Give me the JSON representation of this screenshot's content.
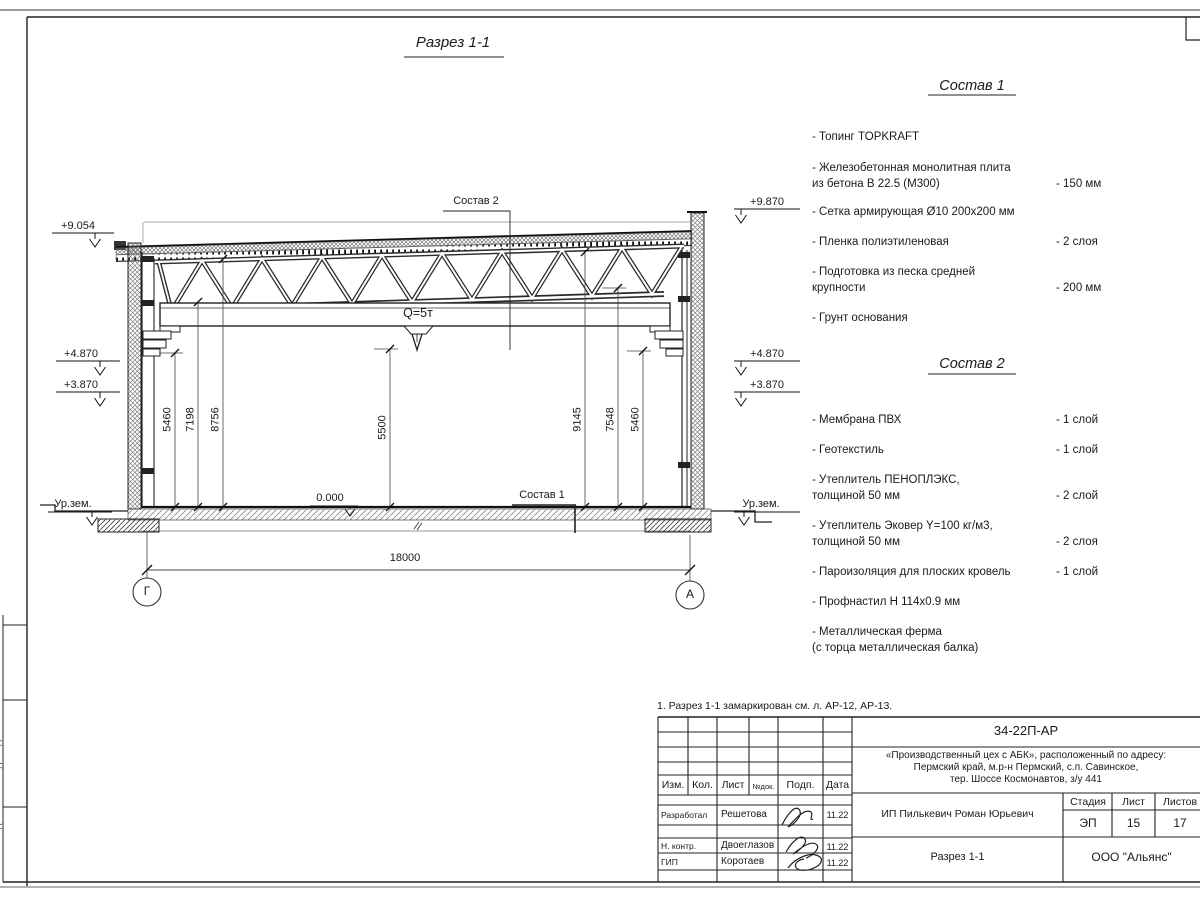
{
  "sheet": {
    "note": "1. Разрез 1-1 замаркирован см. л. АР-12, АР-13.",
    "side_strip": [
      "Взам. инв. №",
      "Подп. и дата",
      "Инв. № подл."
    ]
  },
  "section": {
    "title": "Разрез 1-1",
    "callout_sostav2": "Состав 2",
    "callout_sostav1": "Состав 1",
    "crane_capacity": "Q=5т",
    "zero_level": "0.000",
    "elev_left": {
      "roof": "+9.054",
      "crane": "+4.870",
      "low": "+3.870",
      "ground": "Ур.зем."
    },
    "elev_right": {
      "roof": "+9.870",
      "crane": "+4.870",
      "low": "+3.870",
      "ground": "Ур.зем."
    },
    "dims_left": [
      "5460",
      "7198",
      "8756"
    ],
    "dim_center": "5500",
    "dims_right": [
      "9145",
      "7548",
      "5460"
    ],
    "dim_span": "18000",
    "axis_left": "Г",
    "axis_right": "А"
  },
  "sostav1": {
    "title": "Состав 1",
    "items": [
      {
        "text": "- Топинг TOPKRAFT",
        "value": ""
      },
      {
        "text": "- Железобетонная  монолитная плита\nиз бетона В 22.5 (М300)",
        "value": "- 150 мм"
      },
      {
        "text": "- Сетка армирующая Ø10 200x200 мм",
        "value": ""
      },
      {
        "text": "- Пленка полиэтиленовая",
        "value": "-  2 слоя"
      },
      {
        "text": "- Подготовка из песка средней\nкрупности",
        "value": "- 200 мм"
      },
      {
        "text": "- Грунт основания",
        "value": ""
      }
    ]
  },
  "sostav2": {
    "title": "Состав 2",
    "items": [
      {
        "text": "- Мембрана ПВХ",
        "value": "- 1 слой"
      },
      {
        "text": "- Геотекстиль",
        "value": "- 1 слой"
      },
      {
        "text": "- Утеплитель ПЕНОПЛЭКС,\nтолщиной 50 мм",
        "value": "- 2 слой"
      },
      {
        "text": "- Утеплитель Эковер Y=100 кг/м3,\nтолщиной 50 мм",
        "value": "- 2 слоя"
      },
      {
        "text": "- Пароизоляция для плоских кровель",
        "value": "- 1 слой"
      },
      {
        "text": "- Профнастил Н 114x0.9 мм",
        "value": ""
      },
      {
        "text": "- Металлическая ферма\n(с торца металлическая балка)",
        "value": ""
      }
    ]
  },
  "titleblock": {
    "doc_number": "34-22П-АР",
    "project_line1": "«Производственный цех с АБК», расположенный по адресу:",
    "project_line2": "Пермский край, м.р-н Пермский, с.п. Савинское,",
    "project_line3": "тер. Шоссе Космонавтов, з/у 441",
    "col_izm": "Изм.",
    "col_kol": "Кол.",
    "col_list": "Лист",
    "col_ndok": "№док.",
    "col_podp": "Подп.",
    "col_data": "Дата",
    "row1_role": "Разработал",
    "row1_name": "Решетова",
    "row1_date": "11.22",
    "row2_role": "Н. контр.",
    "row2_name": "Двоеглазов",
    "row2_date": "11.22",
    "row3_role": "ГИП",
    "row3_name": "Коротаев",
    "row3_date": "11.22",
    "client": "ИП Пилькевич Роман Юрьевич",
    "stage_label": "Стадия",
    "sheet_label": "Лист",
    "sheets_label": "Листов",
    "stage": "ЭП",
    "sheet_num": "15",
    "sheets_total": "17",
    "sheet_title": "Разрез 1-1",
    "company": "ООО \"Альянс\""
  }
}
